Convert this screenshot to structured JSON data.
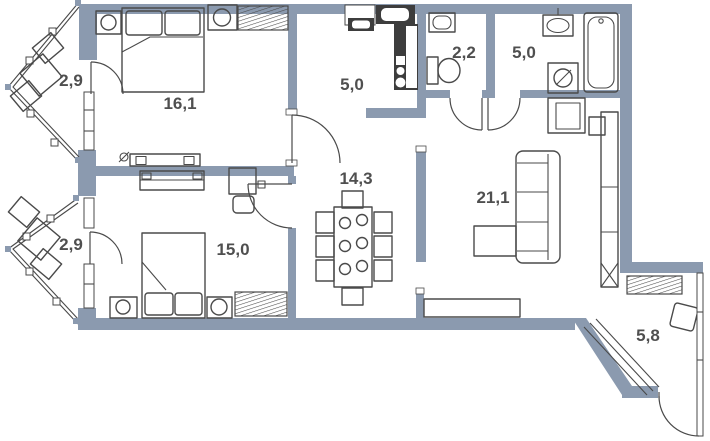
{
  "page": {
    "width": 710,
    "height": 441,
    "background": "#ffffff"
  },
  "colors": {
    "wall": "#8b9aaf",
    "line": "#4a4a4a",
    "label": "#4f4f4f",
    "dark": "#3d3d3d"
  },
  "plan": {
    "type": "apartment-floor-plan",
    "rooms": [
      {
        "id": "balcony-top",
        "area": "2,9",
        "furniture": [
          "table",
          "chair",
          "chair"
        ]
      },
      {
        "id": "bedroom-1",
        "area": "16,1",
        "furniture": [
          "double-bed",
          "nightstand-lamp",
          "nightstand-lamp",
          "radiator",
          "dresser",
          "outlet"
        ]
      },
      {
        "id": "kitchen",
        "area": "5,0",
        "furniture": [
          "window-box",
          "sink",
          "counter",
          "stove"
        ]
      },
      {
        "id": "wc",
        "area": "2,2",
        "furniture": [
          "hand-basin",
          "toilet"
        ]
      },
      {
        "id": "bathroom",
        "area": "5,0",
        "furniture": [
          "washbasin",
          "bathtub",
          "washing-machine"
        ]
      },
      {
        "id": "hall",
        "area": "14,3",
        "furniture": [
          "dining-table",
          "chair",
          "chair",
          "chair",
          "chair",
          "chair",
          "chair",
          "head-chair",
          "head-chair"
        ]
      },
      {
        "id": "living-room",
        "area": "21,1",
        "furniture": [
          "armchair",
          "side-table",
          "sofa",
          "coffee-table",
          "tv-stand",
          "wardrobe"
        ]
      },
      {
        "id": "balcony-middle",
        "area": "2,9",
        "furniture": [
          "table",
          "chair",
          "chair"
        ]
      },
      {
        "id": "bedroom-2",
        "area": "15,0",
        "furniture": [
          "wardrobe",
          "desk",
          "desk-chair",
          "double-bed",
          "nightstand-lamp",
          "nightstand-lamp",
          "radiator"
        ]
      },
      {
        "id": "balcony-bottom",
        "area": "5,8",
        "furniture": [
          "radiator",
          "stool"
        ]
      }
    ]
  }
}
